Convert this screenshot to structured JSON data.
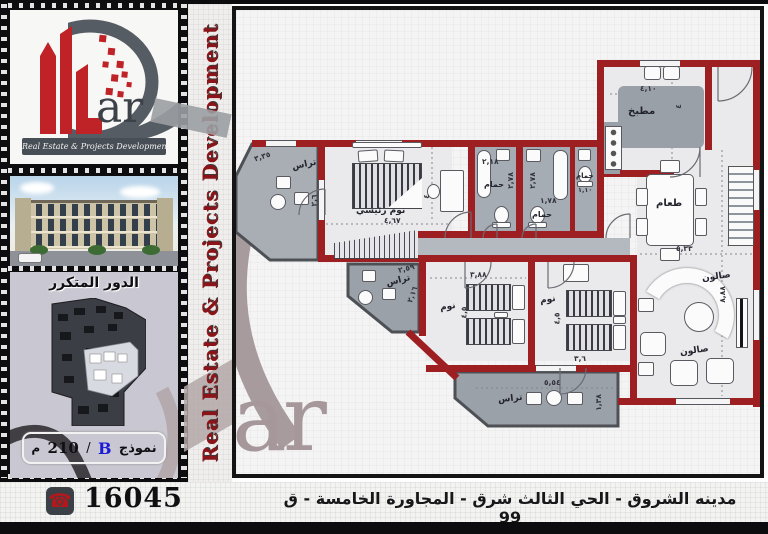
{
  "logo": {
    "suffix": "ar",
    "tagline": "Real Estate & Projects Development"
  },
  "vertical_banner": {
    "text": "Real Estate & Projects Development"
  },
  "watermark": {
    "text": "ar"
  },
  "sidebar": {
    "floor_label": "الدور المتكرر",
    "model_box": {
      "label": "نموذج",
      "letter": "B",
      "separator": "/",
      "area": "210",
      "unit": "م"
    }
  },
  "footer": {
    "phone": "16045",
    "phone_icon": "☎",
    "address": "مدينه الشروق - الحي الثالث شرق - المجاورة الخامسة - ق 99"
  },
  "colors": {
    "wall_red": "#9e1f22",
    "logo_red": "#bf2328",
    "banner_red": "#8c1418",
    "model_letter_blue": "#1b1bd6",
    "sidebar_lavender": "#c9c7d1",
    "watermark_mauve": "#a89b9d"
  },
  "plan": {
    "labels": {
      "kitchen_name": "مطبخ",
      "kitchen_dim_w": "٤,١٠",
      "kitchen_dim_h": "٤",
      "master_name": "نوم رئيسي",
      "master_dim_w": "٤,٦٧",
      "master_dim_h": "٤",
      "terrace1_name": "تراس",
      "terrace1_dim_w": "٣,٣٥",
      "terrace1_dim_h": "٢,٦",
      "bath1_name": "حمام",
      "bath1_dim_w": "٢,١٨",
      "bath1_dim_h": "٢,٧٨",
      "bath2_name": "حمام",
      "bath2_dim_w": "١,٧٨",
      "bath2_dim_h": "٢,٧٨",
      "bath3_name": "حمام",
      "bath3_dim": "١,١٠",
      "dining_name": "طعام",
      "dining_dim_w": "٥,٣٣",
      "salon_name_upper": "صالون",
      "salon_name_lower": "صالون",
      "salon_dim_h": "٨,٨٨",
      "bedroom2_name": "نوم",
      "bedroom2_dim_w": "٣,٨٨",
      "bedroom2_dim_h": "٤,٥",
      "bedroom3_name": "نوم",
      "bedroom3_dim_w": "٣,٦",
      "bedroom3_dim_h": "٤,٥",
      "terrace2_name": "تراس",
      "terrace2_dim_w": "٢,٥٩",
      "terrace2_dim_h": "٢,١٦",
      "terrace3_name": "تراس",
      "terrace3_dim_w": "٥,٥٤",
      "terrace3_dim_h": "١,٣٨"
    }
  }
}
